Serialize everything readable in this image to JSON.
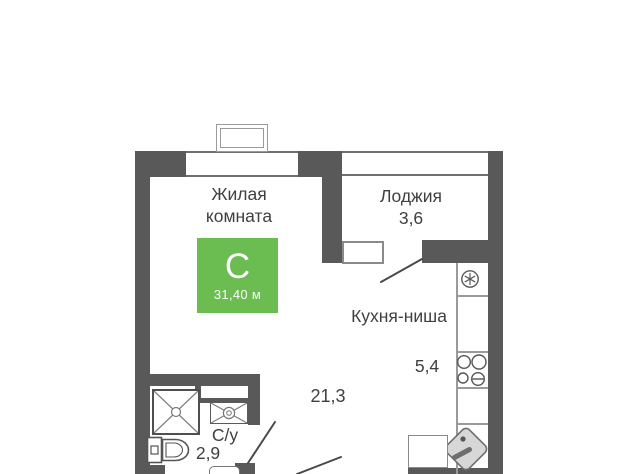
{
  "plan": {
    "living": {
      "line1": "Жилая",
      "line2": "комната"
    },
    "badge": {
      "type_letter": "С",
      "area_label": "31,40 м",
      "color": "#6bbd52"
    },
    "loggia": {
      "name": "Лоджия",
      "area": "3,6"
    },
    "kitchen": {
      "name": "Кухня-ниша",
      "area": "5,4"
    },
    "open_space": {
      "area": "21,3"
    },
    "bathroom": {
      "name": "С/у",
      "area": "2,9"
    },
    "colors": {
      "wall": "#595959",
      "accent_green": "#6bbd52",
      "text": "#404040",
      "fixture_line": "#6e6e6e"
    },
    "icons": [
      "fridge-icon",
      "stove-icon",
      "kitchen-sink-icon",
      "shower-icon",
      "washing-machine-icon",
      "toilet-icon",
      "bathroom-sink-icon"
    ]
  }
}
